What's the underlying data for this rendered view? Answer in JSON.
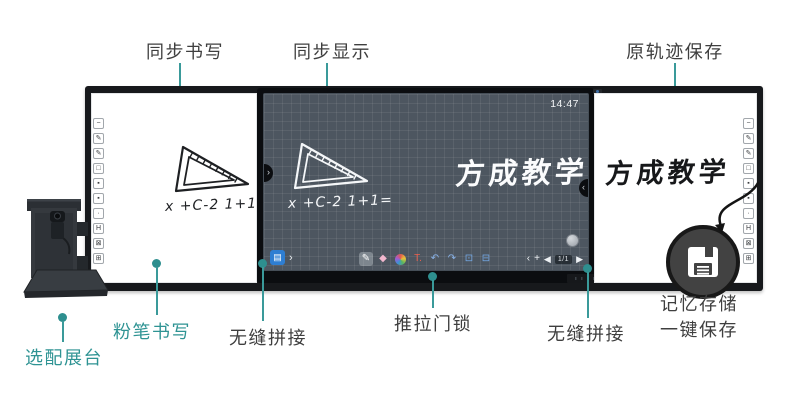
{
  "colors": {
    "accent_teal": "#3A9A9A",
    "teal_text": "#2E9393",
    "label_text": "#3F3F3F",
    "frame": "#17191C",
    "screen_background": "#4D5660",
    "toolbar_blue": "#2E7ED2"
  },
  "top_callouts": [
    {
      "label": "同步书写"
    },
    {
      "label": "同步显示"
    },
    {
      "label": "原轨迹保存"
    }
  ],
  "bottom_callouts": {
    "stand": {
      "label": "选配展台"
    },
    "chalk": {
      "label": "粉笔书写"
    },
    "seam_left": {
      "label": "无缝拼接"
    },
    "lock": {
      "label": "推拉门锁"
    },
    "seam_right": {
      "label": "无缝拼接"
    },
    "memory": {
      "line1": "记忆存储",
      "line2": "一键保存"
    }
  },
  "board": {
    "clock": "14:47",
    "handwriting": "x +C-2 1+1=",
    "calligraphy": "方成教学",
    "tabs": {
      "left": "›",
      "right": "‹"
    },
    "side_tools": [
      {
        "name": "minus-icon",
        "glyph": "−"
      },
      {
        "name": "pen-icon",
        "glyph": "✎"
      },
      {
        "name": "pencil-icon",
        "glyph": "✎"
      },
      {
        "name": "board-icon",
        "glyph": "□"
      },
      {
        "name": "dot-bold-icon",
        "glyph": "▪"
      },
      {
        "name": "dot-icon",
        "glyph": "▪"
      },
      {
        "name": "dot-small-icon",
        "glyph": "·"
      },
      {
        "name": "handle-icon",
        "glyph": "H"
      },
      {
        "name": "close-grid-icon",
        "glyph": "⊠"
      },
      {
        "name": "grid-icon",
        "glyph": "⊞"
      }
    ],
    "toolbar": {
      "menu_glyph": "▤",
      "expand_glyph": "›",
      "tools": [
        {
          "name": "pen-tool-icon",
          "glyph": "✎",
          "color": "#FFFFFF",
          "active": true
        },
        {
          "name": "eraser-tool-icon",
          "glyph": "◆",
          "color": "#F2B8CF"
        },
        {
          "name": "palette-tool-icon",
          "palette": true
        },
        {
          "name": "text-tool-icon",
          "glyph": "T.",
          "color": "#E8604F"
        },
        {
          "name": "undo-icon",
          "glyph": "↶",
          "color": "#8AB4EA"
        },
        {
          "name": "redo-icon",
          "glyph": "↷",
          "color": "#8AB4EA"
        },
        {
          "name": "select-tool-icon",
          "glyph": "⊡",
          "color": "#74A9E6"
        },
        {
          "name": "trash-icon",
          "glyph": "⊟",
          "color": "#74A9E6"
        }
      ],
      "pager": {
        "collapse": "‹",
        "add": "+",
        "prev": "◀",
        "page": "1/1",
        "next": "▶"
      }
    }
  }
}
